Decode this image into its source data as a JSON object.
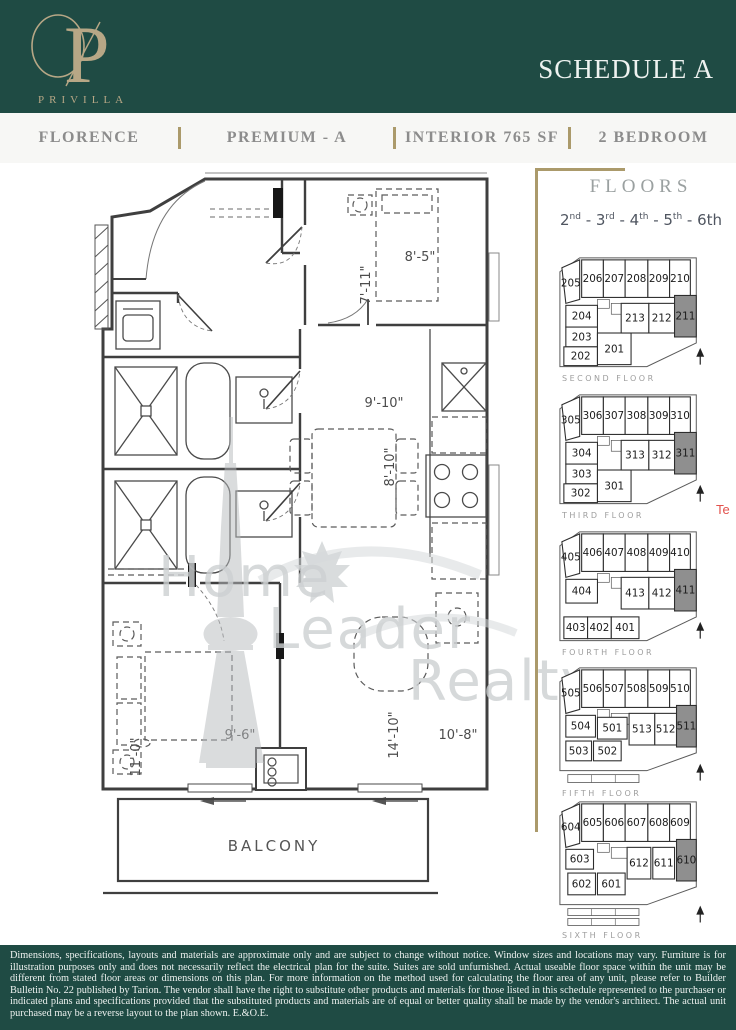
{
  "header": {
    "logo_letter": "P",
    "logo_name": "PRIVILLA",
    "schedule_title": "SCHEDULE A"
  },
  "subheader": {
    "items": [
      "FLORENCE",
      "PREMIUM - A",
      "INTERIOR 765 SF",
      "2 BEDROOM"
    ]
  },
  "plan": {
    "dims": {
      "bedroom2_w": "8'-5\"",
      "bedroom2_h": "7'-11\"",
      "kitchen_w": "9'-10\"",
      "kitchen_h": "8'-10\"",
      "bedroom1_w": "9'-6\"",
      "bedroom1_h": "11'-0\"",
      "living_h": "14'-10\"",
      "living_w": "10'-8\""
    },
    "balcony_label": "BALCONY"
  },
  "watermark": {
    "lines": [
      "Home",
      "Leader",
      "Realty"
    ]
  },
  "side_note": "Te",
  "floors_panel": {
    "title": "FLOORS",
    "ordinals": [
      {
        "num": "2",
        "suffix": "nd",
        "sup": true
      },
      {
        "num": "3",
        "suffix": "rd",
        "sup": true
      },
      {
        "num": "4",
        "suffix": "th",
        "sup": true
      },
      {
        "num": "5",
        "suffix": "th",
        "sup": true
      },
      {
        "num": "6",
        "suffix": "th",
        "sup": false
      }
    ],
    "floors": [
      {
        "label": "SECOND FLOOR",
        "vb_h": 124,
        "outline": "8,22 28,8 146,8 146,94 96,118 8,118",
        "para": {
          "n": "205",
          "points": "10,18 28,10 28,50 14,54",
          "lx": 19,
          "ly": 37
        },
        "units": [
          {
            "n": "206",
            "x": 30,
            "y": 10,
            "w": 22,
            "h": 38
          },
          {
            "n": "207",
            "x": 52,
            "y": 10,
            "w": 22,
            "h": 38
          },
          {
            "n": "208",
            "x": 74,
            "y": 10,
            "w": 23,
            "h": 38
          },
          {
            "n": "209",
            "x": 97,
            "y": 10,
            "w": 22,
            "h": 38
          },
          {
            "n": "210",
            "x": 119,
            "y": 10,
            "w": 21,
            "h": 38
          },
          {
            "n": "204",
            "x": 14,
            "y": 56,
            "w": 32,
            "h": 22
          },
          {
            "n": "203",
            "x": 14,
            "y": 78,
            "w": 32,
            "h": 20
          },
          {
            "n": "202",
            "x": 12,
            "y": 98,
            "w": 34,
            "h": 19
          },
          {
            "n": "201",
            "x": 46,
            "y": 84,
            "w": 34,
            "h": 32
          },
          {
            "n": "213",
            "x": 70,
            "y": 54,
            "w": 28,
            "h": 30
          },
          {
            "n": "212",
            "x": 98,
            "y": 54,
            "w": 26,
            "h": 30
          },
          {
            "n": "211",
            "x": 124,
            "y": 46,
            "w": 22,
            "h": 42,
            "hl": true
          }
        ],
        "strips": [],
        "core": [
          [
            46,
            50,
            12,
            9
          ],
          [
            60,
            54,
            22,
            11
          ]
        ]
      },
      {
        "label": "THIRD FLOOR",
        "vb_h": 124,
        "outline": "8,22 28,8 146,8 146,94 96,118 8,118",
        "para": {
          "n": "305",
          "points": "10,18 28,10 28,50 14,54",
          "lx": 19,
          "ly": 37
        },
        "units": [
          {
            "n": "306",
            "x": 30,
            "y": 10,
            "w": 22,
            "h": 38
          },
          {
            "n": "307",
            "x": 52,
            "y": 10,
            "w": 22,
            "h": 38
          },
          {
            "n": "308",
            "x": 74,
            "y": 10,
            "w": 23,
            "h": 38
          },
          {
            "n": "309",
            "x": 97,
            "y": 10,
            "w": 22,
            "h": 38
          },
          {
            "n": "310",
            "x": 119,
            "y": 10,
            "w": 21,
            "h": 38
          },
          {
            "n": "304",
            "x": 14,
            "y": 56,
            "w": 32,
            "h": 22
          },
          {
            "n": "303",
            "x": 14,
            "y": 78,
            "w": 32,
            "h": 20
          },
          {
            "n": "302",
            "x": 12,
            "y": 98,
            "w": 34,
            "h": 19
          },
          {
            "n": "301",
            "x": 46,
            "y": 84,
            "w": 34,
            "h": 32
          },
          {
            "n": "313",
            "x": 70,
            "y": 54,
            "w": 28,
            "h": 30
          },
          {
            "n": "312",
            "x": 98,
            "y": 54,
            "w": 26,
            "h": 30
          },
          {
            "n": "311",
            "x": 124,
            "y": 46,
            "w": 22,
            "h": 42,
            "hl": true
          }
        ],
        "strips": [],
        "core": [
          [
            46,
            50,
            12,
            9
          ],
          [
            60,
            54,
            22,
            11
          ]
        ]
      },
      {
        "label": "FOURTH FLOOR",
        "vb_h": 124,
        "outline": "8,22 28,8 146,8 146,94 96,118 8,118",
        "para": {
          "n": "405",
          "points": "10,18 28,10 28,50 14,54",
          "lx": 19,
          "ly": 37
        },
        "units": [
          {
            "n": "406",
            "x": 30,
            "y": 10,
            "w": 22,
            "h": 38
          },
          {
            "n": "407",
            "x": 52,
            "y": 10,
            "w": 22,
            "h": 38
          },
          {
            "n": "408",
            "x": 74,
            "y": 10,
            "w": 23,
            "h": 38
          },
          {
            "n": "409",
            "x": 97,
            "y": 10,
            "w": 22,
            "h": 38
          },
          {
            "n": "410",
            "x": 119,
            "y": 10,
            "w": 21,
            "h": 38
          },
          {
            "n": "404",
            "x": 14,
            "y": 56,
            "w": 32,
            "h": 24
          },
          {
            "n": "403",
            "x": 12,
            "y": 94,
            "w": 24,
            "h": 22
          },
          {
            "n": "402",
            "x": 36,
            "y": 94,
            "w": 24,
            "h": 22
          },
          {
            "n": "401",
            "x": 60,
            "y": 94,
            "w": 28,
            "h": 22
          },
          {
            "n": "413",
            "x": 70,
            "y": 54,
            "w": 28,
            "h": 32
          },
          {
            "n": "412",
            "x": 98,
            "y": 54,
            "w": 26,
            "h": 32
          },
          {
            "n": "411",
            "x": 124,
            "y": 46,
            "w": 22,
            "h": 42,
            "hl": true
          }
        ],
        "strips": [],
        "core": [
          [
            46,
            50,
            12,
            9
          ],
          [
            60,
            54,
            22,
            11
          ]
        ]
      },
      {
        "label": "FIFTH FLOOR",
        "vb_h": 130,
        "outline": "8,22 28,8 146,8 146,94 96,112 8,112",
        "para": {
          "n": "505",
          "points": "10,18 28,10 28,50 14,54",
          "lx": 19,
          "ly": 37
        },
        "units": [
          {
            "n": "506",
            "x": 30,
            "y": 10,
            "w": 22,
            "h": 38
          },
          {
            "n": "507",
            "x": 52,
            "y": 10,
            "w": 22,
            "h": 38
          },
          {
            "n": "508",
            "x": 74,
            "y": 10,
            "w": 23,
            "h": 38
          },
          {
            "n": "509",
            "x": 97,
            "y": 10,
            "w": 22,
            "h": 38
          },
          {
            "n": "510",
            "x": 119,
            "y": 10,
            "w": 21,
            "h": 38
          },
          {
            "n": "504",
            "x": 14,
            "y": 56,
            "w": 30,
            "h": 22
          },
          {
            "n": "501",
            "x": 46,
            "y": 58,
            "w": 30,
            "h": 22
          },
          {
            "n": "503",
            "x": 14,
            "y": 82,
            "w": 26,
            "h": 20
          },
          {
            "n": "502",
            "x": 42,
            "y": 82,
            "w": 28,
            "h": 20
          },
          {
            "n": "513",
            "x": 78,
            "y": 54,
            "w": 26,
            "h": 32
          },
          {
            "n": "512",
            "x": 104,
            "y": 54,
            "w": 22,
            "h": 32
          },
          {
            "n": "511",
            "x": 126,
            "y": 46,
            "w": 20,
            "h": 42,
            "hl": true
          }
        ],
        "strips": [
          [
            16,
            116,
            72,
            8
          ]
        ],
        "core": [
          [
            46,
            50,
            12,
            9
          ],
          [
            60,
            54,
            22,
            11
          ]
        ]
      },
      {
        "label": "SIXTH FLOOR",
        "vb_h": 138,
        "outline": "8,22 28,8 146,8 146,94 96,112 8,112",
        "para": {
          "n": "604",
          "points": "10,18 28,10 28,50 14,54",
          "lx": 19,
          "ly": 37
        },
        "units": [
          {
            "n": "605",
            "x": 30,
            "y": 10,
            "w": 22,
            "h": 38
          },
          {
            "n": "606",
            "x": 52,
            "y": 10,
            "w": 22,
            "h": 38
          },
          {
            "n": "607",
            "x": 74,
            "y": 10,
            "w": 23,
            "h": 38
          },
          {
            "n": "608",
            "x": 97,
            "y": 10,
            "w": 22,
            "h": 38
          },
          {
            "n": "609",
            "x": 119,
            "y": 10,
            "w": 21,
            "h": 38
          },
          {
            "n": "603",
            "x": 14,
            "y": 56,
            "w": 28,
            "h": 20
          },
          {
            "n": "602",
            "x": 16,
            "y": 80,
            "w": 28,
            "h": 22
          },
          {
            "n": "601",
            "x": 46,
            "y": 80,
            "w": 28,
            "h": 22
          },
          {
            "n": "612",
            "x": 76,
            "y": 54,
            "w": 24,
            "h": 32
          },
          {
            "n": "611",
            "x": 102,
            "y": 54,
            "w": 22,
            "h": 32
          },
          {
            "n": "610",
            "x": 126,
            "y": 46,
            "w": 20,
            "h": 42,
            "hl": true
          }
        ],
        "strips": [
          [
            16,
            116,
            72,
            7
          ],
          [
            16,
            126,
            72,
            7
          ]
        ],
        "core": [
          [
            46,
            50,
            12,
            9
          ],
          [
            60,
            54,
            22,
            11
          ]
        ]
      }
    ]
  },
  "footer": {
    "disclaimer": "Dimensions, specifications, layouts and materials are approximate only and are subject to change without notice. Window sizes and locations may vary. Furniture is for illustration purposes only and does not necessarily reflect the electrical plan for the suite. Suites are sold unfurnished. Actual useable floor space within the unit may be different from stated floor areas or dimensions on this plan. For more information on the method used for calculating the floor area of any unit, please refer to Builder Bulletin No. 22 published by Tarion. The vendor shall have the right to substitute other products and materials for those listed in this schedule represented to the purchaser or indicated plans and specifications provided that the substituted products and materials are of equal or better quality shall be made by the vendor's architect. The actual unit purchased may be a reverse layout to the plan shown. E.&O.E."
  },
  "colors": {
    "teal": "#1f4b44",
    "gold": "#ab9a6b",
    "logo_gold": "#b7a786",
    "highlight_unit": "#8f8f8f",
    "red_note": "#e2514c"
  }
}
